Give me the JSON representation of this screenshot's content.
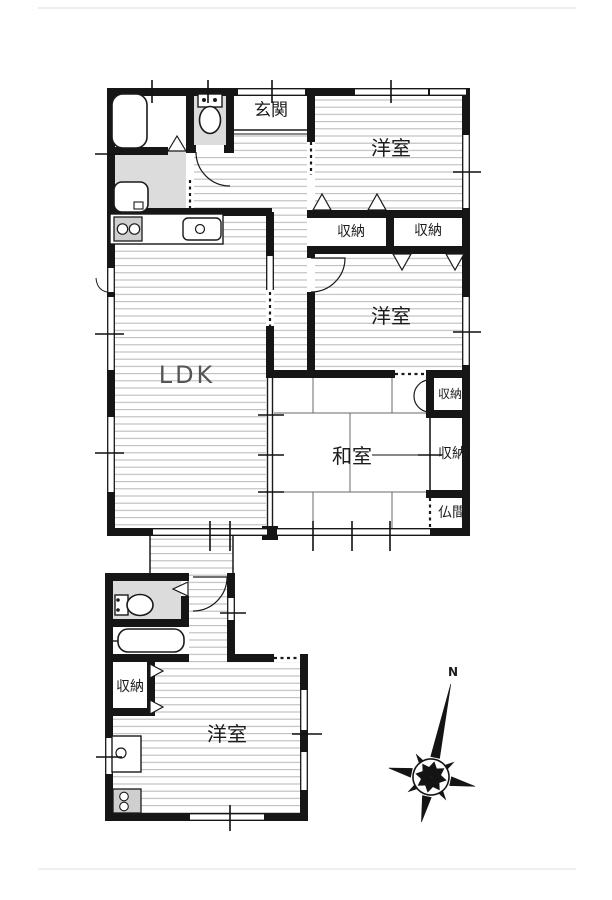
{
  "plan": {
    "rooms": {
      "genkan": "玄関",
      "bedroom_ne": "洋室",
      "bedroom_e": "洋室",
      "bedroom_annex": "洋室",
      "ldk": "LDK",
      "washitsu": "和室",
      "butsuma": "仏間",
      "closet_n1": "収納",
      "closet_n2": "収納",
      "closet_e1": "収納",
      "closet_e2": "収納",
      "closet_annex": "収納"
    },
    "compass": {
      "north": "N"
    },
    "colors": {
      "wall": "#161616",
      "wet_room_floor": "#dcdcdc",
      "floor_stripe": "#b6b6b6",
      "stove": "#cfcfcf"
    }
  }
}
